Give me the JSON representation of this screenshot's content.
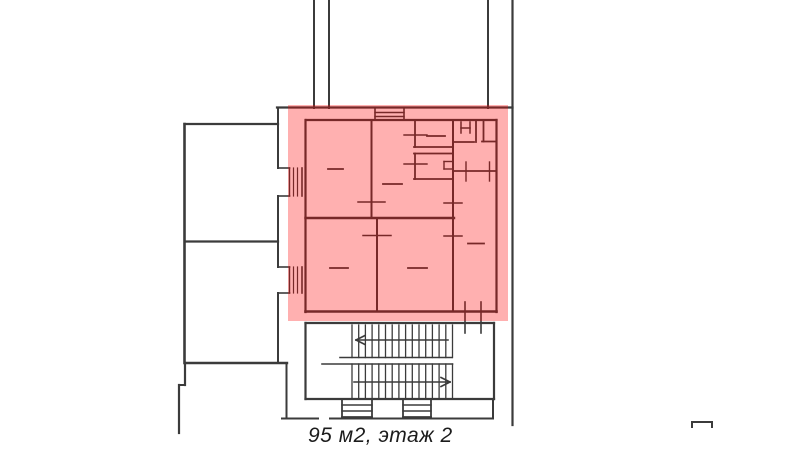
{
  "page": {
    "width": 800,
    "height": 451,
    "background": "#ffffff"
  },
  "caption": {
    "text": "95 м2, этаж 2",
    "area": "95 м2",
    "floor": "этаж 2"
  },
  "highlight": {
    "color": "#ff0000",
    "opacity": 0.31,
    "x": 288,
    "y": 105,
    "width": 220,
    "height": 216
  },
  "plan": {
    "stroke_color": "#3b3b3b",
    "segments": [
      [
        314,
        0,
        314,
        108,
        2
      ],
      [
        329,
        0,
        329,
        108,
        2
      ],
      [
        488,
        0,
        488,
        108,
        2
      ],
      [
        512.5,
        0,
        512.5,
        425,
        2.2
      ],
      [
        277,
        107.5,
        512.5,
        107.5,
        2.2
      ],
      [
        184.5,
        124,
        278,
        124,
        2.2
      ],
      [
        184.5,
        124,
        184.5,
        363,
        2.6
      ],
      [
        185,
        241.5,
        278,
        241.5,
        2.2
      ],
      [
        185,
        363,
        287,
        363,
        2.4
      ],
      [
        278,
        108,
        278,
        168,
        2
      ],
      [
        278,
        168,
        289.5,
        168,
        1.6
      ],
      [
        278,
        196,
        289.5,
        196,
        1.6
      ],
      [
        278,
        196,
        278,
        267,
        2
      ],
      [
        278,
        267,
        289.5,
        267,
        1.6
      ],
      [
        278,
        293,
        289.5,
        293,
        1.6
      ],
      [
        278,
        293,
        278,
        363,
        2
      ],
      [
        289.5,
        168,
        289.5,
        196,
        1.4
      ],
      [
        302,
        168,
        302,
        196,
        1.6
      ],
      [
        293.5,
        168,
        293.5,
        196,
        1.2
      ],
      [
        297.5,
        168,
        297.5,
        196,
        1.2
      ],
      [
        289.5,
        267,
        289.5,
        293,
        1.4
      ],
      [
        302,
        267,
        302,
        293,
        1.6
      ],
      [
        293.5,
        267,
        293.5,
        293,
        1.2
      ],
      [
        297.5,
        267,
        297.5,
        293,
        1.2
      ],
      [
        185,
        363,
        185,
        385,
        2.2
      ],
      [
        179,
        385,
        185,
        385,
        2
      ],
      [
        179,
        385,
        179,
        433,
        2.2
      ],
      [
        286.5,
        365,
        286.5,
        418.5,
        2
      ],
      [
        282,
        418.5,
        318,
        418.5,
        2
      ],
      [
        330,
        418.5,
        493,
        418.5,
        2
      ],
      [
        493,
        399,
        493,
        418.5,
        2
      ],
      [
        692,
        422,
        712,
        422,
        2
      ],
      [
        692,
        422,
        692,
        427,
        2
      ],
      [
        712,
        422,
        712,
        427,
        2
      ],
      [
        305.5,
        323,
        494,
        323,
        2.2
      ],
      [
        305.5,
        323,
        305.5,
        399,
        2.2
      ],
      [
        494,
        323,
        494,
        399,
        2.2
      ],
      [
        305.5,
        399,
        494,
        399,
        2.2
      ],
      [
        340,
        357.5,
        452,
        357.5,
        1.6
      ],
      [
        322,
        364,
        452.5,
        364,
        1.6
      ],
      [
        352,
        325,
        352,
        357.5,
        1.3
      ],
      [
        358.7,
        325,
        358.7,
        357.5,
        1.3
      ],
      [
        365.4,
        325,
        365.4,
        357.5,
        1.3
      ],
      [
        372.1,
        325,
        372.1,
        357.5,
        1.3
      ],
      [
        378.8,
        325,
        378.8,
        357.5,
        1.3
      ],
      [
        385.5,
        325,
        385.5,
        357.5,
        1.3
      ],
      [
        392.2,
        325,
        392.2,
        357.5,
        1.3
      ],
      [
        398.9,
        325,
        398.9,
        357.5,
        1.3
      ],
      [
        405.6,
        325,
        405.6,
        357.5,
        1.3
      ],
      [
        412.3,
        325,
        412.3,
        357.5,
        1.3
      ],
      [
        419,
        325,
        419,
        357.5,
        1.3
      ],
      [
        425.7,
        325,
        425.7,
        357.5,
        1.3
      ],
      [
        432.4,
        325,
        432.4,
        357.5,
        1.3
      ],
      [
        439.1,
        325,
        439.1,
        357.5,
        1.3
      ],
      [
        445.8,
        325,
        445.8,
        357.5,
        1.3
      ],
      [
        452.5,
        325,
        452.5,
        357.5,
        1.3
      ],
      [
        352,
        364,
        352,
        398,
        1.3
      ],
      [
        358.7,
        364,
        358.7,
        398,
        1.3
      ],
      [
        365.4,
        364,
        365.4,
        398,
        1.3
      ],
      [
        372.1,
        364,
        372.1,
        398,
        1.3
      ],
      [
        378.8,
        364,
        378.8,
        398,
        1.3
      ],
      [
        385.5,
        364,
        385.5,
        398,
        1.3
      ],
      [
        392.2,
        364,
        392.2,
        398,
        1.3
      ],
      [
        398.9,
        364,
        398.9,
        398,
        1.3
      ],
      [
        405.6,
        364,
        405.6,
        398,
        1.3
      ],
      [
        412.3,
        364,
        412.3,
        398,
        1.3
      ],
      [
        419,
        364,
        419,
        398,
        1.3
      ],
      [
        425.7,
        364,
        425.7,
        398,
        1.3
      ],
      [
        432.4,
        364,
        432.4,
        398,
        1.3
      ],
      [
        439.1,
        364,
        439.1,
        398,
        1.3
      ],
      [
        445.8,
        364,
        445.8,
        398,
        1.3
      ],
      [
        452.5,
        364,
        452.5,
        398,
        1.3
      ],
      [
        356,
        340,
        448,
        340,
        1.6
      ],
      [
        356,
        340,
        365,
        335.5,
        1.6
      ],
      [
        356,
        340,
        365,
        344.5,
        1.6
      ],
      [
        354,
        382,
        450,
        382,
        1.6
      ],
      [
        450,
        382,
        441,
        377.5,
        1.6
      ],
      [
        450,
        382,
        441,
        386.5,
        1.6
      ],
      [
        342,
        399,
        342,
        417,
        1.8
      ],
      [
        372,
        399,
        372,
        417,
        1.8
      ],
      [
        342,
        417,
        372,
        417,
        1.8
      ],
      [
        342,
        405,
        372,
        405,
        1.4
      ],
      [
        342,
        411,
        372,
        411,
        1.4
      ],
      [
        403,
        399,
        403,
        417,
        1.8
      ],
      [
        431,
        399,
        431,
        417,
        1.8
      ],
      [
        403,
        417,
        431,
        417,
        1.8
      ],
      [
        403,
        405,
        431,
        405,
        1.4
      ],
      [
        403,
        411,
        431,
        411,
        1.4
      ],
      [
        306,
        120,
        496.5,
        120,
        2.2
      ],
      [
        305.5,
        120,
        305.5,
        312,
        2.2
      ],
      [
        496.5,
        120,
        496.5,
        312,
        2.2
      ],
      [
        305.5,
        311.5,
        496.5,
        311.5,
        2.6
      ],
      [
        375,
        108.5,
        375,
        120,
        1.6
      ],
      [
        404,
        108.5,
        404,
        120,
        1.6
      ],
      [
        375,
        112.5,
        404,
        112.5,
        1.4
      ],
      [
        375,
        116.5,
        404,
        116.5,
        1.4
      ],
      [
        371.5,
        120,
        371.5,
        218,
        2
      ],
      [
        358,
        202,
        385,
        202,
        1.5
      ],
      [
        305.5,
        218,
        454,
        218,
        2.4
      ],
      [
        377,
        218,
        377,
        311.5,
        2
      ],
      [
        363,
        235.5,
        391,
        235.5,
        1.5
      ],
      [
        453,
        120,
        453,
        311.5,
        2
      ],
      [
        444,
        203,
        462,
        203,
        1.5
      ],
      [
        444,
        236,
        462,
        236,
        1.5
      ],
      [
        415,
        120,
        415,
        147,
        1.8
      ],
      [
        404,
        135,
        427,
        135,
        1.4
      ],
      [
        414,
        147,
        453,
        147,
        1.8
      ],
      [
        414,
        153.5,
        453,
        153.5,
        1.8
      ],
      [
        415,
        153.5,
        415,
        179,
        1.8
      ],
      [
        404,
        164,
        427,
        164,
        1.4
      ],
      [
        414,
        179,
        453,
        179,
        1.8
      ],
      [
        444,
        161.5,
        452,
        161.5,
        1.4
      ],
      [
        444,
        161.5,
        444,
        169,
        1.4
      ],
      [
        444,
        169,
        452,
        169,
        1.4
      ],
      [
        476,
        120,
        476,
        142,
        1.8
      ],
      [
        453,
        142,
        474,
        142,
        1.8
      ],
      [
        482,
        141.5,
        496.5,
        141.5,
        1.8
      ],
      [
        483.5,
        120,
        483.5,
        141.5,
        1.8
      ],
      [
        461,
        122,
        461,
        133,
        1.5
      ],
      [
        470,
        122,
        470,
        133,
        1.5
      ],
      [
        461,
        128,
        470,
        128,
        1.5
      ],
      [
        453,
        171,
        496.5,
        171,
        1.8
      ],
      [
        466,
        162,
        466,
        181,
        1.4
      ],
      [
        489.5,
        162,
        489.5,
        181,
        1.4
      ],
      [
        328,
        169,
        343,
        169,
        1.8
      ],
      [
        383,
        184,
        402,
        184,
        1.8
      ],
      [
        427,
        136,
        445,
        136,
        1.8
      ],
      [
        330,
        268,
        348,
        268,
        1.8
      ],
      [
        408,
        268,
        427,
        268,
        1.8
      ],
      [
        468,
        243.5,
        484,
        243.5,
        1.8
      ],
      [
        465,
        302,
        465,
        333,
        1.6
      ],
      [
        481,
        302,
        481,
        333,
        1.6
      ]
    ]
  }
}
